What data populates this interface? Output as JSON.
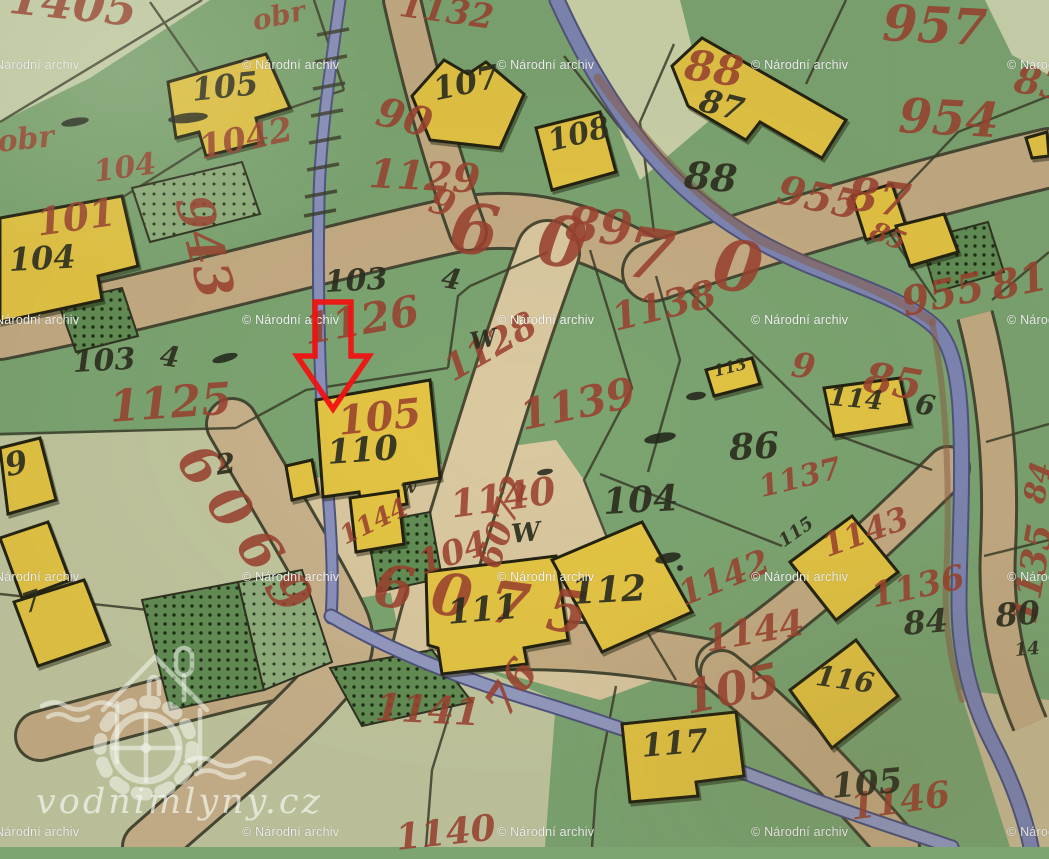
{
  "watermark": {
    "text": "© Národní archiv",
    "color": "#ffffff",
    "rows": [
      58,
      313,
      570,
      825
    ],
    "cols": [
      -18,
      242,
      497,
      751,
      1007
    ]
  },
  "logo": {
    "text": "vodnimlyny.cz"
  },
  "marker": {
    "shape": "down-arrow-outline",
    "color": "#f01212",
    "tip_x": 333,
    "tip_y": 409
  },
  "palette": {
    "field_green": "#7CA572",
    "pale_sage": "#C2C7A0",
    "cream_parcel": "#DAC8A0",
    "road_tan": "#C5AC84",
    "stream_blue": "#7E86B5",
    "building_yellow": "#E5C544",
    "ink_black": "#2B2D1E",
    "parcel_red": "#9A402E",
    "arrow_red": "#F01212"
  },
  "labels": {
    "red": [
      {
        "text": "1405",
        "x": 12,
        "y": -26,
        "s": 46,
        "rot": 6
      },
      {
        "text": "obr",
        "x": 250,
        "y": 8,
        "s": 28,
        "rot": -12
      },
      {
        "text": "1132",
        "x": 402,
        "y": -12,
        "s": 34,
        "rot": 8
      },
      {
        "text": "957",
        "x": 884,
        "y": -2,
        "s": 50,
        "rot": 3
      },
      {
        "text": "88",
        "x": 688,
        "y": 44,
        "s": 42,
        "rot": 8
      },
      {
        "text": "954",
        "x": 900,
        "y": 92,
        "s": 48,
        "rot": 3
      },
      {
        "text": "obr",
        "x": -4,
        "y": 128,
        "s": 30,
        "rot": -6
      },
      {
        "text": "1042",
        "x": 196,
        "y": 132,
        "s": 34,
        "rot": -12
      },
      {
        "text": "104",
        "x": 92,
        "y": 158,
        "s": 30,
        "rot": -8
      },
      {
        "text": "90",
        "x": 382,
        "y": 92,
        "s": 40,
        "rot": 14
      },
      {
        "text": "1129",
        "x": 370,
        "y": 154,
        "s": 40,
        "rot": 3
      },
      {
        "text": "9",
        "x": 436,
        "y": 182,
        "s": 36,
        "rot": 18
      },
      {
        "text": "89",
        "x": 568,
        "y": 200,
        "s": 48,
        "rot": 5
      },
      {
        "text": "955",
        "x": 782,
        "y": 170,
        "s": 40,
        "rot": 12
      },
      {
        "text": "87",
        "x": 850,
        "y": 170,
        "s": 46,
        "rot": 8
      },
      {
        "text": "85",
        "x": 876,
        "y": 218,
        "s": 26,
        "rot": 22
      },
      {
        "text": "83",
        "x": 1018,
        "y": 60,
        "s": 38,
        "rot": 10
      },
      {
        "text": "6070",
        "x": 455,
        "y": 192,
        "s": 70,
        "rot": 8,
        "ls": 40
      },
      {
        "text": "101",
        "x": 34,
        "y": 204,
        "s": 38,
        "rot": -8
      },
      {
        "text": "943",
        "x": 216,
        "y": 190,
        "s": 50,
        "rot": 76
      },
      {
        "text": "1125",
        "x": 108,
        "y": 386,
        "s": 44,
        "rot": -4
      },
      {
        "text": "1126",
        "x": 300,
        "y": 310,
        "s": 42,
        "rot": -10
      },
      {
        "text": "105",
        "x": 336,
        "y": 402,
        "s": 40,
        "rot": -6
      },
      {
        "text": "1128",
        "x": 438,
        "y": 356,
        "s": 36,
        "rot": -30
      },
      {
        "text": "6072",
        "x": 472,
        "y": 562,
        "s": 34,
        "rot": -72
      },
      {
        "text": "1138",
        "x": 608,
        "y": 300,
        "s": 38,
        "rot": -14
      },
      {
        "text": "1139",
        "x": 516,
        "y": 396,
        "s": 42,
        "rot": -12
      },
      {
        "text": "955",
        "x": 898,
        "y": 284,
        "s": 40,
        "rot": -12
      },
      {
        "text": "81",
        "x": 988,
        "y": 268,
        "s": 40,
        "rot": -12
      },
      {
        "text": "85",
        "x": 868,
        "y": 356,
        "s": 42,
        "rot": 10
      },
      {
        "text": "9",
        "x": 794,
        "y": 348,
        "s": 34,
        "rot": 8
      },
      {
        "text": "1137",
        "x": 756,
        "y": 474,
        "s": 30,
        "rot": -14
      },
      {
        "text": "1136",
        "x": 868,
        "y": 580,
        "s": 34,
        "rot": -12
      },
      {
        "text": "84",
        "x": 1020,
        "y": 500,
        "s": 30,
        "rot": -78
      },
      {
        "text": "1135",
        "x": 1006,
        "y": 620,
        "s": 36,
        "rot": -80
      },
      {
        "text": "1140",
        "x": 448,
        "y": 486,
        "s": 38,
        "rot": -8
      },
      {
        "text": "1144",
        "x": 336,
        "y": 526,
        "s": 26,
        "rot": -26
      },
      {
        "text": "104",
        "x": 414,
        "y": 548,
        "s": 34,
        "rot": -18
      },
      {
        "text": "6075",
        "x": 378,
        "y": 556,
        "s": 58,
        "rot": 8,
        "ls": 18
      },
      {
        "text": "1142",
        "x": 674,
        "y": 580,
        "s": 34,
        "rot": -22
      },
      {
        "text": "1143",
        "x": 818,
        "y": 532,
        "s": 32,
        "rot": -20
      },
      {
        "text": "1144",
        "x": 702,
        "y": 622,
        "s": 36,
        "rot": -10
      },
      {
        "text": "105",
        "x": 680,
        "y": 676,
        "s": 46,
        "rot": -12
      },
      {
        "text": "76",
        "x": 478,
        "y": 700,
        "s": 42,
        "rot": -56
      },
      {
        "text": "1141",
        "x": 376,
        "y": 688,
        "s": 38,
        "rot": 3
      },
      {
        "text": "1140",
        "x": 394,
        "y": 820,
        "s": 36,
        "rot": -6
      },
      {
        "text": "6069",
        "x": 212,
        "y": 434,
        "s": 54,
        "rot": 55,
        "ls": 14
      },
      {
        "text": "1146",
        "x": 848,
        "y": 790,
        "s": 36,
        "rot": -8
      }
    ],
    "black": [
      {
        "text": "105",
        "x": 190,
        "y": 74,
        "s": 32,
        "rot": -6
      },
      {
        "text": "104",
        "x": 8,
        "y": 244,
        "s": 32,
        "rot": -3
      },
      {
        "text": "107",
        "x": 430,
        "y": 74,
        "s": 32,
        "rot": -12
      },
      {
        "text": "108",
        "x": 545,
        "y": 128,
        "s": 30,
        "rot": -14
      },
      {
        "text": "87",
        "x": 704,
        "y": 84,
        "s": 32,
        "rot": 14
      },
      {
        "text": "88",
        "x": 686,
        "y": 156,
        "s": 38,
        "rot": 5
      },
      {
        "text": "103",
        "x": 324,
        "y": 268,
        "s": 30,
        "rot": -3
      },
      {
        "text": "103",
        "x": 72,
        "y": 348,
        "s": 30,
        "rot": -3
      },
      {
        "text": "110",
        "x": 326,
        "y": 436,
        "s": 34,
        "rot": -4
      },
      {
        "text": "86",
        "x": 728,
        "y": 430,
        "s": 36,
        "rot": -3
      },
      {
        "text": "104",
        "x": 602,
        "y": 484,
        "s": 36,
        "rot": -3
      },
      {
        "text": "W",
        "x": 468,
        "y": 330,
        "s": 24,
        "rot": -10
      },
      {
        "text": "W",
        "x": 510,
        "y": 522,
        "s": 26,
        "rot": -6
      },
      {
        "text": "w",
        "x": 400,
        "y": 480,
        "s": 18,
        "rot": -6
      },
      {
        "text": "6",
        "x": 918,
        "y": 390,
        "s": 28,
        "rot": 10
      },
      {
        "text": "113",
        "x": 712,
        "y": 364,
        "s": 16,
        "rot": -14
      },
      {
        "text": "114",
        "x": 830,
        "y": 384,
        "s": 26,
        "rot": 5
      },
      {
        "text": "111",
        "x": 446,
        "y": 596,
        "s": 34,
        "rot": -5
      },
      {
        "text": "112",
        "x": 570,
        "y": 574,
        "s": 36,
        "rot": -3
      },
      {
        "text": "115",
        "x": 776,
        "y": 536,
        "s": 18,
        "rot": -35
      },
      {
        "text": "116",
        "x": 818,
        "y": 662,
        "s": 28,
        "rot": 8
      },
      {
        "text": "117",
        "x": 640,
        "y": 730,
        "s": 32,
        "rot": -5
      },
      {
        "text": "105",
        "x": 830,
        "y": 770,
        "s": 34,
        "rot": -5
      },
      {
        "text": "84",
        "x": 902,
        "y": 608,
        "s": 32,
        "rot": -5
      },
      {
        "text": "80",
        "x": 994,
        "y": 600,
        "s": 32,
        "rot": -5
      },
      {
        "text": "9",
        "x": 2,
        "y": 450,
        "s": 32,
        "rot": -12
      },
      {
        "text": "7",
        "x": 18,
        "y": 592,
        "s": 28,
        "rot": -18
      },
      {
        "text": "4",
        "x": 444,
        "y": 264,
        "s": 28,
        "rot": 10
      },
      {
        "text": "4",
        "x": 162,
        "y": 342,
        "s": 28,
        "rot": 8
      },
      {
        "text": "2",
        "x": 214,
        "y": 452,
        "s": 28,
        "rot": -8
      },
      {
        "text": "14",
        "x": 1014,
        "y": 642,
        "s": 18,
        "rot": -5
      }
    ]
  }
}
